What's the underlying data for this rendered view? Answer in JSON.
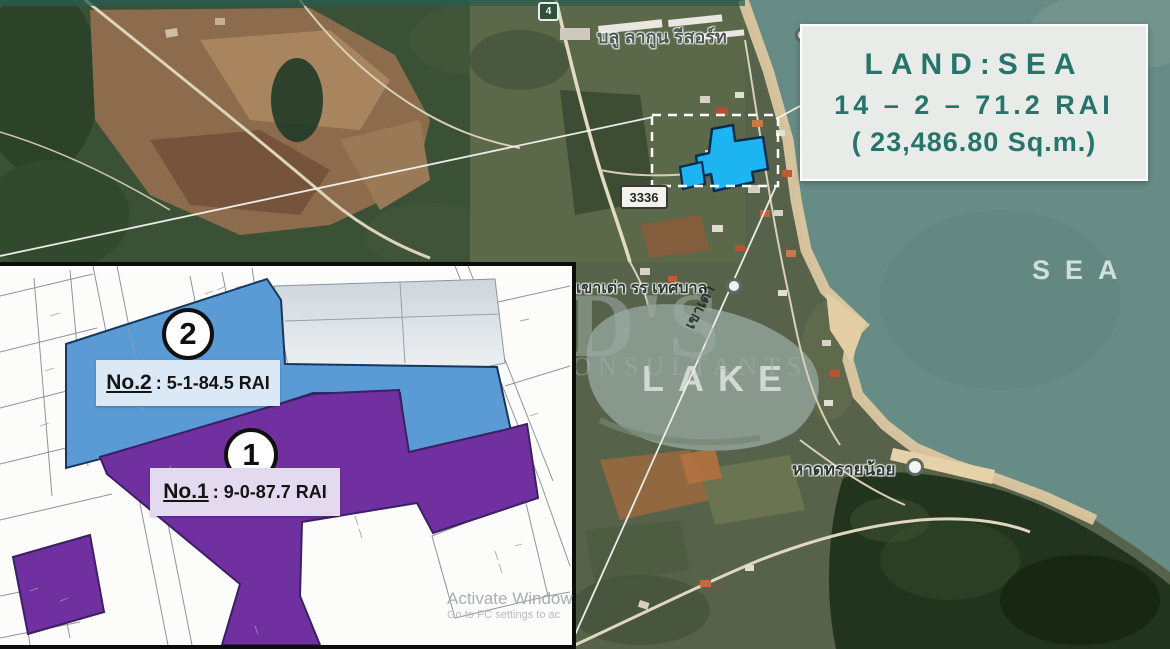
{
  "info_box": {
    "title": "LAND:SEA",
    "line1": "14 – 2 – 71.2 RAI",
    "line2": "( 23,486.80  Sq.m.)"
  },
  "labels": {
    "sea": "SEA",
    "lake": "LAKE",
    "resort": "บลู ลากูน รีสอร์ท",
    "school": "านเขาเต่า รร เทศบาล",
    "beach": "หาดทรายน้อย",
    "route_box": "3336",
    "route_shield": "4",
    "hill": "เขาเต่า"
  },
  "brand_watermark": {
    "name": "RD'S",
    "sub": "CONSULTANTS"
  },
  "system_watermark": {
    "line1": "Activate Window",
    "line2": "Go to PC settings to ac"
  },
  "inset": {
    "plots": [
      {
        "id": "1",
        "name": "No.1",
        "area": ": 9-0-87.7  RAI"
      },
      {
        "id": "2",
        "name": "No.2",
        "area": ": 5-1-84.5 RAI"
      }
    ]
  },
  "colors": {
    "plot1": "#7030a0",
    "plot2": "#5b9bd5",
    "highlight": "#1cb5f2",
    "accent": "#27746a",
    "sea": "#678b85"
  }
}
